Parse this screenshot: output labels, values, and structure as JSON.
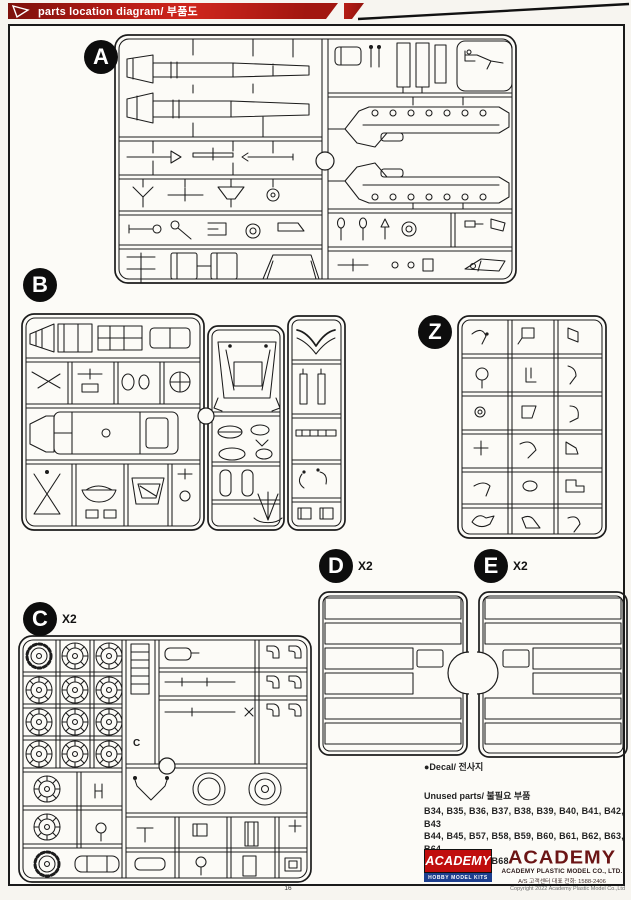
{
  "header": {
    "title": "parts location diagram/ 부품도"
  },
  "sprues": {
    "a": {
      "label": "A",
      "qty": ""
    },
    "b": {
      "label": "B",
      "qty": ""
    },
    "z": {
      "label": "Z",
      "qty": ""
    },
    "c": {
      "label": "C",
      "qty": "X2",
      "molded_letter": "C"
    },
    "d": {
      "label": "D",
      "qty": "X2"
    },
    "e": {
      "label": "E",
      "qty": "X2"
    }
  },
  "notes": {
    "decal": "●Decal/ 전사지",
    "unused_title": "Unused parts/ 불필요 부품",
    "unused_lines": [
      "B34, B35, B36, B37, B38, B39, B40, B41, B42, B43",
      "B44, B45, B57, B58, B59, B60, B61, B62, B63, B64",
      "B65, B66, B67, B68",
      "C5, C24X2, C33"
    ]
  },
  "brand": {
    "logo_text": "ACADEMY",
    "logo_sub": "HOBBY MODEL KITS",
    "wordmark": "ACADEMY",
    "company": "ACADEMY PLASTIC MODEL CO., LTD.",
    "service": "A/S 고객센터 대표 전화: 1588-2406"
  },
  "footer": {
    "page_number": "16",
    "copyright": "Copyright 2022 Academy Plastic Model Co.,Ltd"
  },
  "colors": {
    "banner_red": "#b81d16",
    "logo_red": "#c00d0d",
    "logo_blue": "#1c3e8e",
    "wordmark_maroon": "#6b1515"
  }
}
